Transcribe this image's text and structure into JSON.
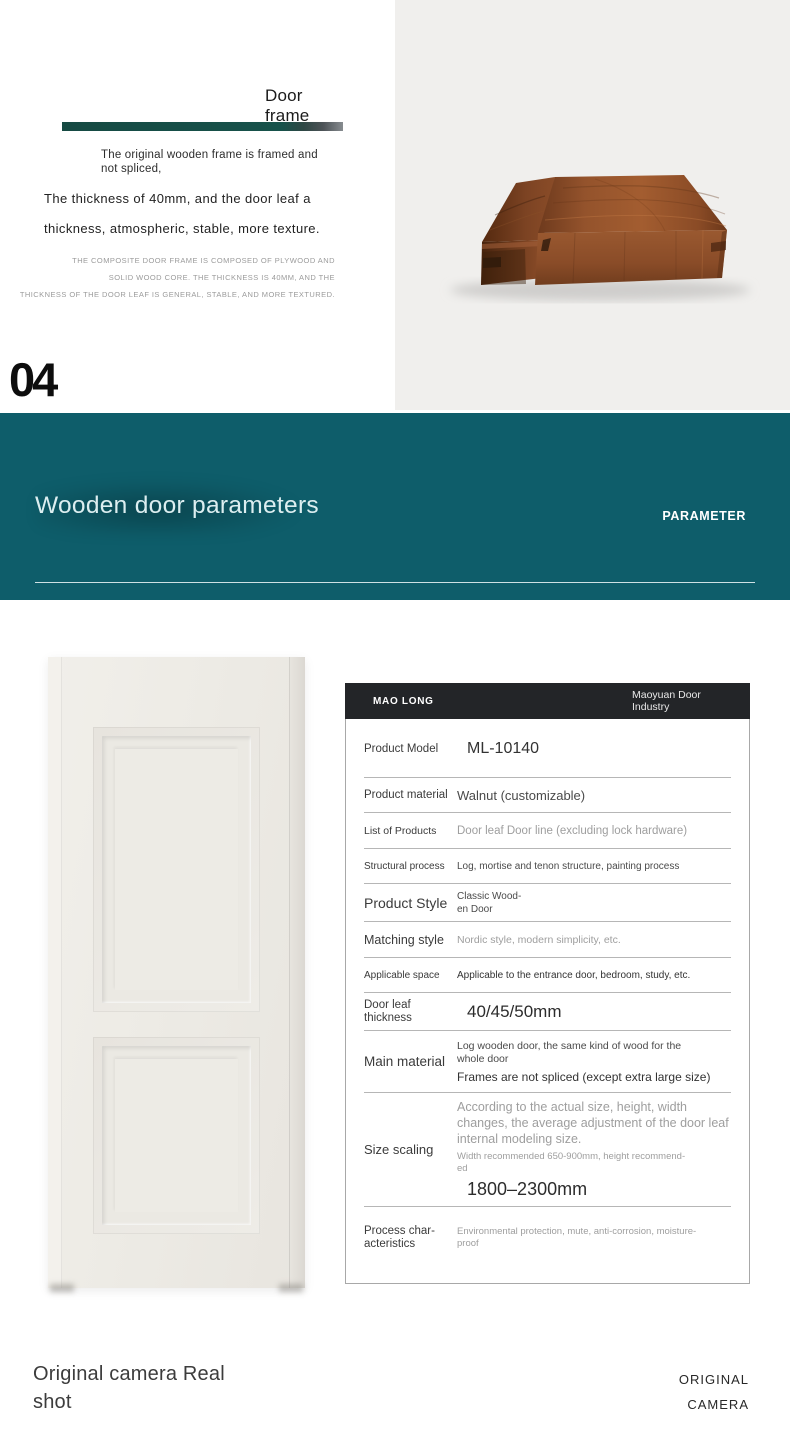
{
  "intro": {
    "heading": {
      "line1": "Door",
      "line2": "frame"
    },
    "lead": {
      "line1": "The original wooden frame is framed and",
      "line2": "not spliced,"
    },
    "line_a": "The thickness of 40mm, and the door leaf a",
    "line_b": "thickness, atmospheric, stable, more texture.",
    "fineprint": {
      "line1": "THE COMPOSITE DOOR FRAME IS COMPOSED OF PLYWOOD AND",
      "line2": "SOLID WOOD CORE. THE THICKNESS IS 40MM, AND THE",
      "line3": "THICKNESS OF THE DOOR LEAF IS GENERAL, STABLE, AND MORE TEXTURED."
    },
    "section_number": "04"
  },
  "banner": {
    "title": "Wooden door parameters",
    "tag": "PARAMETER",
    "bg_color": "#0e5d6a"
  },
  "images": {
    "wood_block": "walnut-door-frame-cross-section-photo",
    "door": "cream-two-panel-wooden-door-photo"
  },
  "spec_table": {
    "brand": "MAO LONG",
    "company": {
      "line1": "Maoyuan Door",
      "line2": "Industry"
    },
    "header_bg": "#232528",
    "rows": [
      {
        "label": "Product Model",
        "value": "ML-10140"
      },
      {
        "label": "Product material",
        "value": "Walnut (customizable)"
      },
      {
        "label": "List of Products",
        "value": "Door leaf Door line (excluding lock hardware)"
      },
      {
        "label": "Structural process",
        "value": "Log, mortise and tenon structure, painting process"
      },
      {
        "label": "Product Style",
        "value_line1": "Classic Wood-",
        "value_line2": "en Door"
      },
      {
        "label": "Matching style",
        "value": "Nordic style, modern simplicity, etc."
      },
      {
        "label": "Applicable space",
        "value": "Applicable to the entrance door, bedroom, study, etc."
      },
      {
        "label_line1": "Door leaf",
        "label_line2": "thickness",
        "value": "40/45/50mm"
      },
      {
        "label": "Main material",
        "value_a": "Log wooden door, the same kind of wood for the whole door",
        "value_b": "Frames are not spliced (except extra large size)"
      },
      {
        "label": "Size scaling",
        "value_a": "According to the actual size, height, width changes, the average adjustment of the door leaf internal modeling size.",
        "value_b_line1": "Width recommended 650-900mm, height recommend-",
        "value_b_line2": "ed",
        "value_c": "1800–2300mm"
      },
      {
        "label_line1": "Process char-",
        "label_line2": "acteristics",
        "value": "Environmental protection, mute, anti-corrosion, moisture-proof"
      }
    ]
  },
  "footer": {
    "title_line1": "Original camera Real",
    "title_line2": "shot",
    "tag_line1": "ORIGINAL",
    "tag_line2": "CAMERA"
  },
  "colors": {
    "banner_teal": "#0e5d6a",
    "accent_bar_teal": "#17524b",
    "table_header_dark": "#232528",
    "photo_background": "#f0efed",
    "door_cream": "#edebe5"
  }
}
